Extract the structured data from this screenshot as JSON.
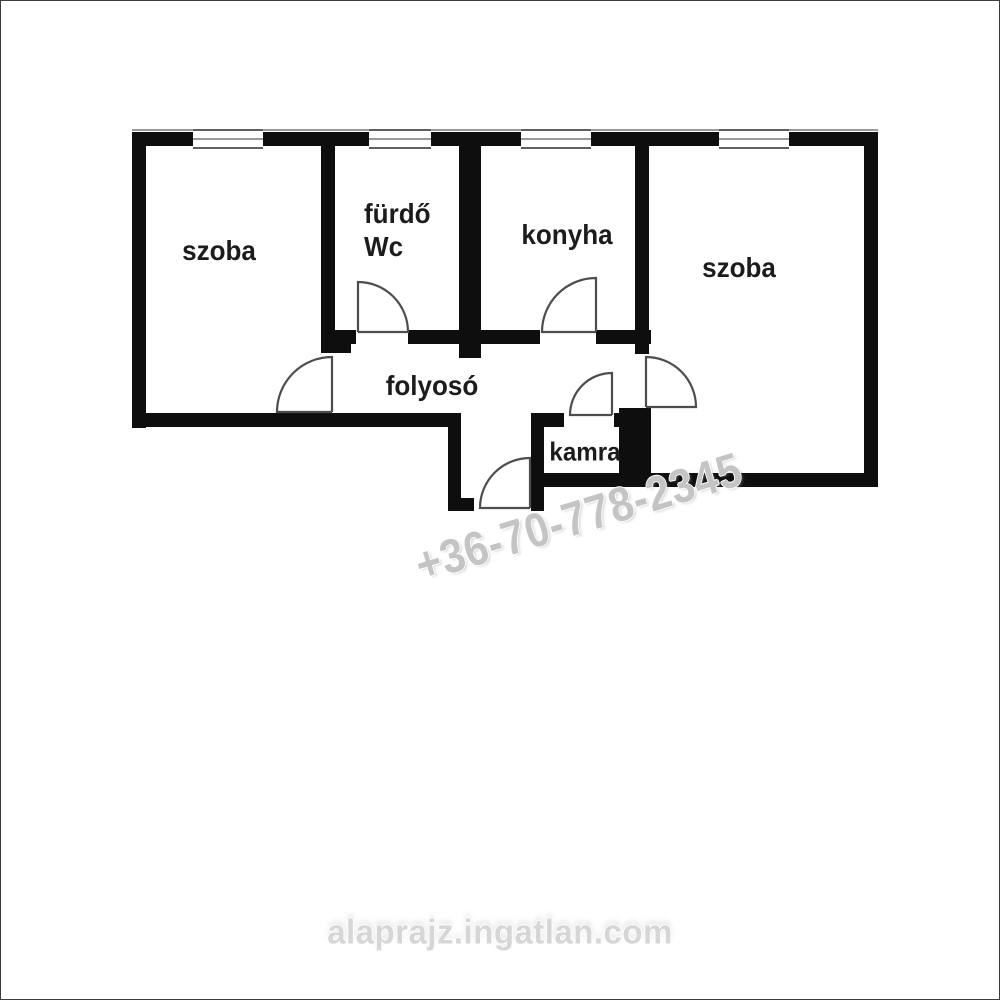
{
  "plan": {
    "rooms": [
      {
        "name": "room-left",
        "label": "szoba"
      },
      {
        "name": "bathroom-wc",
        "label": "fürdő",
        "label2": "Wc"
      },
      {
        "name": "kitchen",
        "label": "konyha"
      },
      {
        "name": "room-right",
        "label": "szoba"
      },
      {
        "name": "hallway",
        "label": "folyosó"
      },
      {
        "name": "pantry",
        "label": "kamra"
      }
    ],
    "window_count": 4,
    "door_count": 6
  },
  "watermarks": {
    "phone": "+36-70-778-2345",
    "site": "alaprajz.ingatlan.com"
  },
  "colors": {
    "background": "#ffffff",
    "wall": "#0e0e0e",
    "door_line": "#4d4d4d",
    "label": "#1c1c1c",
    "watermark_phone": "#c4c4c4",
    "watermark_site": "#d6d6d6"
  }
}
